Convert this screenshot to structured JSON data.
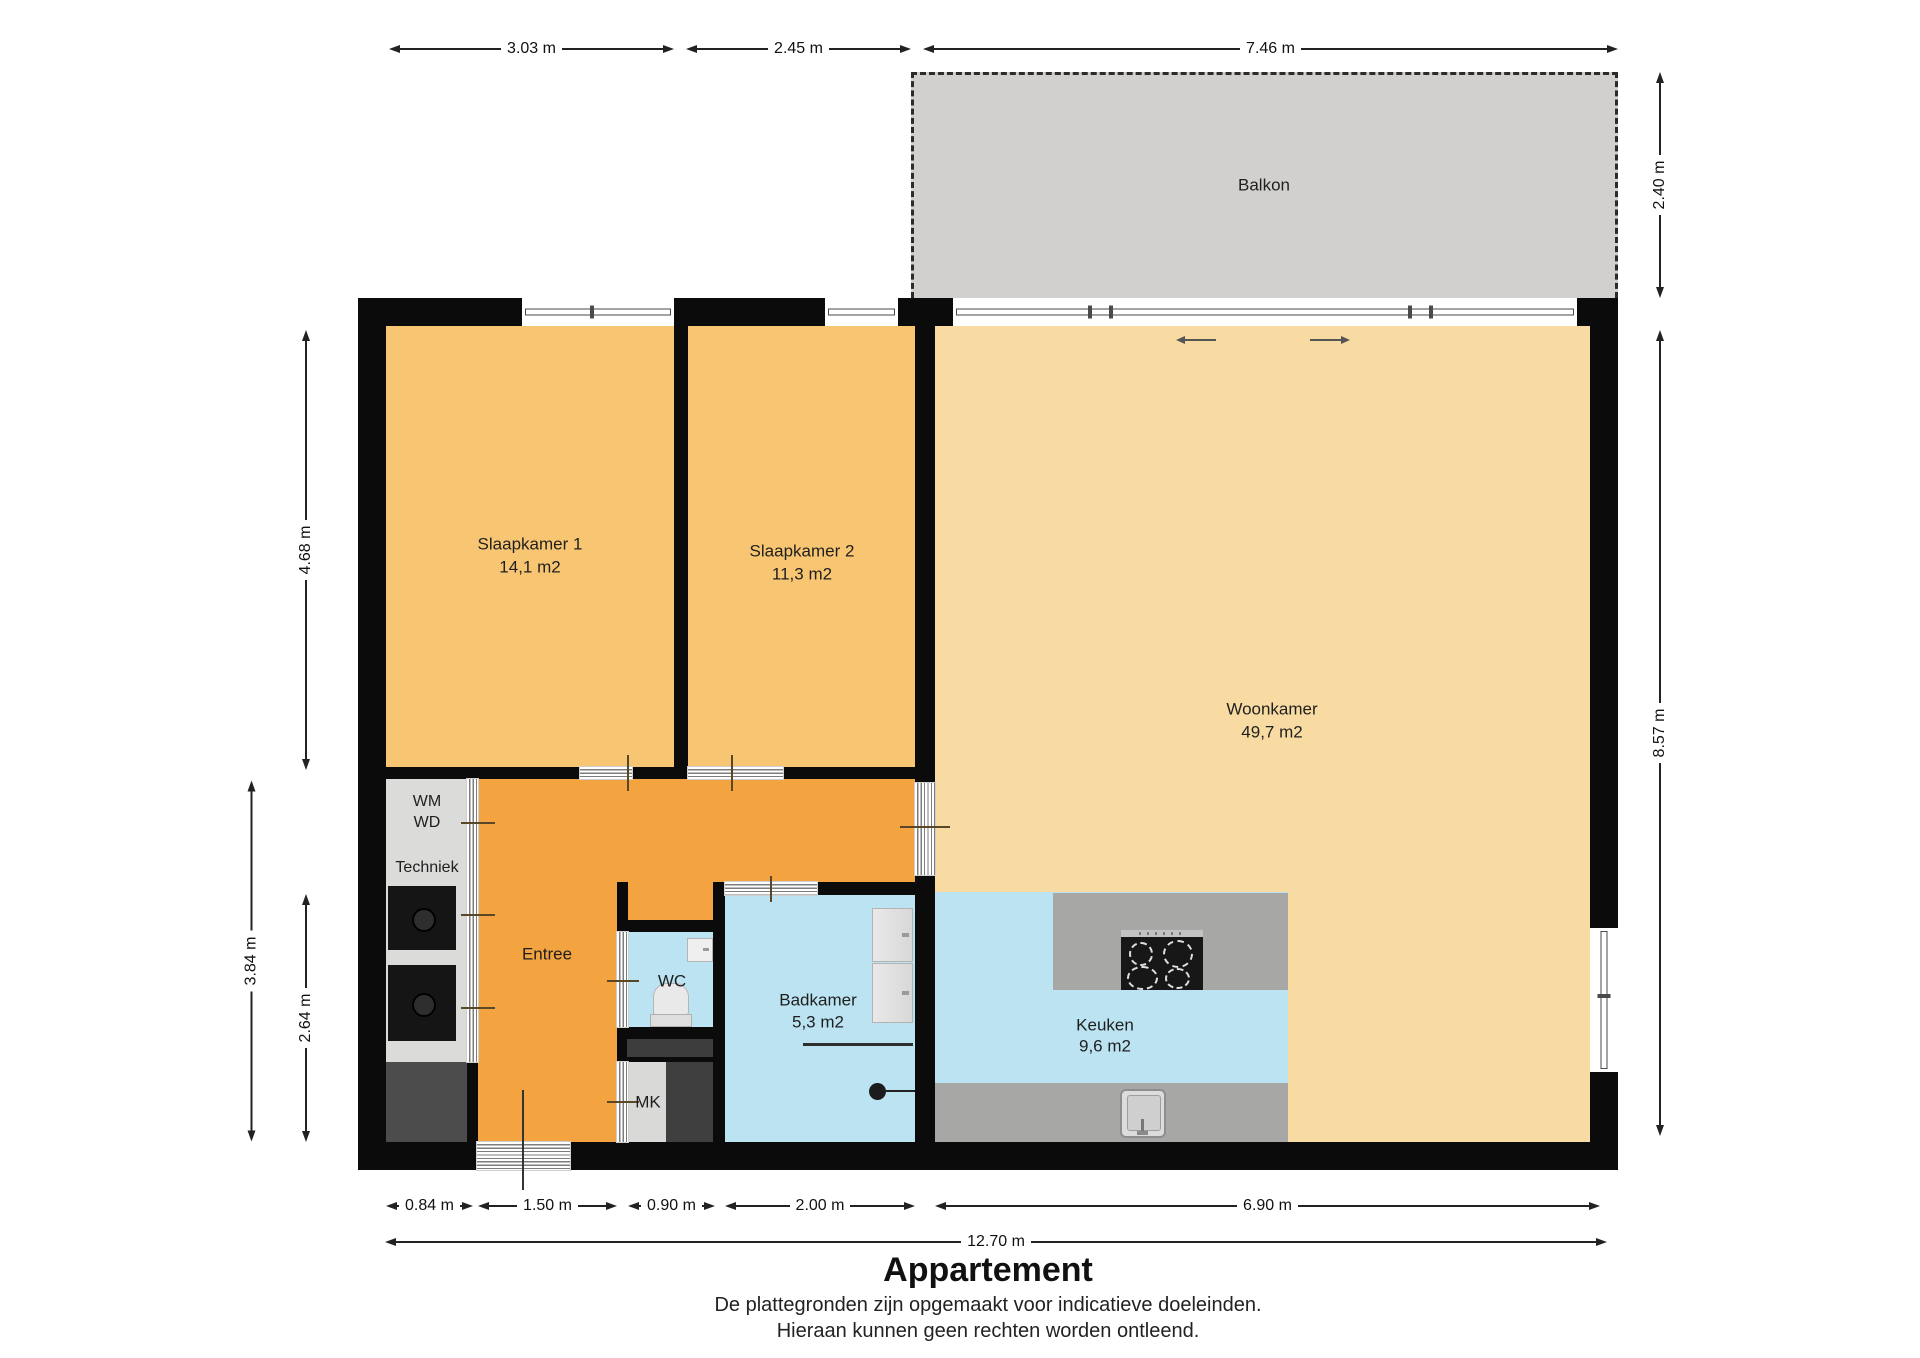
{
  "title": "Appartement",
  "disclaimer": {
    "line1": "De plattegronden zijn opgemaakt voor indicatieve doeleinden.",
    "line2": "Hieraan kunnen geen rechten worden ontleend."
  },
  "balcony": {
    "label": "Balkon"
  },
  "rooms": {
    "slaapkamer1": {
      "name": "Slaapkamer 1",
      "area": "14,1 m2"
    },
    "slaapkamer2": {
      "name": "Slaapkamer 2",
      "area": "11,3 m2"
    },
    "woonkamer": {
      "name": "Woonkamer",
      "area": "49,7 m2"
    },
    "entree": {
      "name": "Entree"
    },
    "wc": {
      "name": "WC"
    },
    "badkamer": {
      "name": "Badkamer",
      "area": "5,3 m2"
    },
    "keuken": {
      "name": "Keuken",
      "area": "9,6 m2"
    },
    "mk": {
      "name": "MK"
    },
    "techniek": {
      "name": "Techniek",
      "wm": "WM",
      "wd": "WD"
    }
  },
  "dimensions": {
    "top": [
      "3.03 m",
      "2.45 m",
      "7.46 m"
    ],
    "right": [
      "2.40 m",
      "8.57 m"
    ],
    "left": [
      "4.68 m",
      "3.84 m",
      "2.64 m"
    ],
    "bottom": [
      "0.84 m",
      "1.50 m",
      "0.90 m",
      "2.00 m",
      "6.90 m"
    ],
    "bottom_total": "12.70 m"
  },
  "colors": {
    "bedroom": "#f8c672",
    "living": "#f8dba2",
    "hall": "#f3a440",
    "wet_room": "#bce3f2",
    "balcony": "#d1d0ce",
    "counter": "#a7a7a5",
    "wall": "#0b0b0b",
    "closet_light": "#dbdbd9",
    "closet_dark": "#4c4c4c"
  }
}
